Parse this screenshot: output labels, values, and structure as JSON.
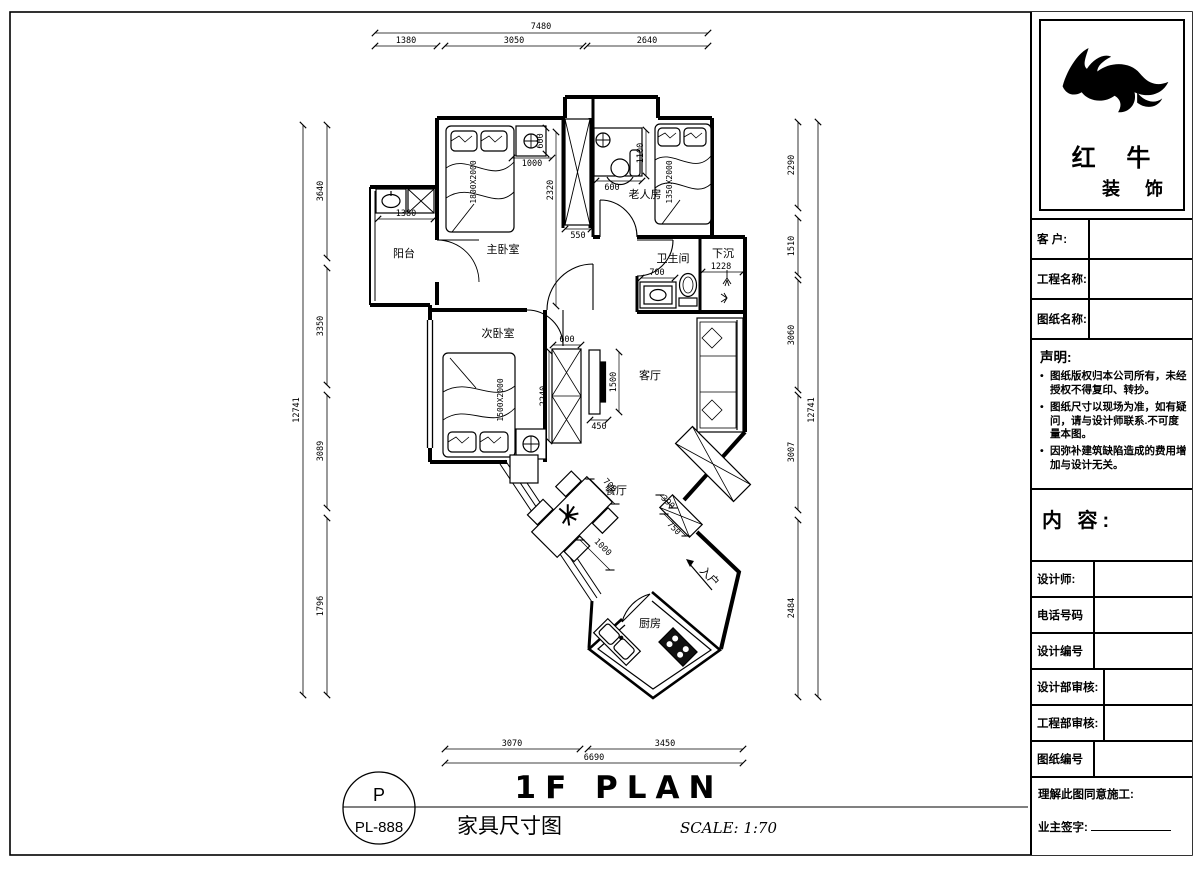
{
  "colors": {
    "ink": "#000000",
    "accent": "#2b2b8c",
    "paper": "#ffffff"
  },
  "title_block": {
    "brand": {
      "line1": "红 牛",
      "line2": "装 饰",
      "logo_icon": "bull-logo"
    },
    "fields": [
      {
        "label": "客 户:"
      },
      {
        "label": "工程名称:"
      },
      {
        "label": "图纸名称:"
      }
    ],
    "statement": {
      "heading": "声明:",
      "items": [
        "图纸版权归本公司所有，未经授权不得复印、转抄。",
        "图纸尺寸以现场为准，如有疑问，请与设计师联系.不可度量本图。",
        "因弥补建筑缺陷造成的费用增加与设计无关。"
      ]
    },
    "content_heading": "内 容:",
    "info_rows": [
      {
        "label": "设计师:"
      },
      {
        "label": "电话号码"
      },
      {
        "label": "设计编号"
      },
      {
        "label": "设计部审核:"
      },
      {
        "label": "工程部审核:"
      },
      {
        "label": "图纸编号"
      }
    ],
    "footer": {
      "line1": "理解此图同意施工:",
      "line2": "业主签字:"
    }
  },
  "plan": {
    "drawing_title": "1F PLAN",
    "drawing_subtitle": "家具尺寸图",
    "scale_label": "SCALE: 1:70",
    "stamp": {
      "top": "P",
      "code": "PL-888"
    },
    "rooms": {
      "balcony": "阳台",
      "master": "主卧室",
      "elder": "老人房",
      "bath": "卫生间",
      "sunken": "下沉",
      "second": "次卧室",
      "living": "客厅",
      "dining": "餐厅",
      "kitchen": "厨房"
    },
    "entry_label": "入户",
    "furniture": {
      "master_bed": "1800X2000",
      "elder_bed": "1350X2000",
      "second_bed": "1500X2000"
    },
    "dims": {
      "top_overall": "7480",
      "top_1": "1380",
      "top_2": "3050",
      "top_3": "2640",
      "left_overall": "12741",
      "left_1": "3640",
      "left_2": "3350",
      "left_3": "3089",
      "left_4": "1796",
      "right_overall": "12741",
      "right_1": "2290",
      "right_2": "1510",
      "right_3": "3060",
      "right_4": "3007",
      "right_5": "2484",
      "bottom_overall": "6690",
      "bottom_1": "3070",
      "bottom_2": "3450",
      "balcony_w": "1380",
      "closet_d": "600",
      "closet_run": "1000",
      "master_len": "2320",
      "closet_w": "550",
      "desk_len": "1100",
      "desk_w": "600",
      "vanity_w": "700",
      "sunken_w": "1228",
      "hall_closet_w": "600",
      "hall_closet_l": "2240",
      "tv_l": "1500",
      "tv_d": "450",
      "table_w": "700",
      "table_l": "1000",
      "entry_cab_w": "390",
      "entry_cab_l": "750"
    }
  }
}
